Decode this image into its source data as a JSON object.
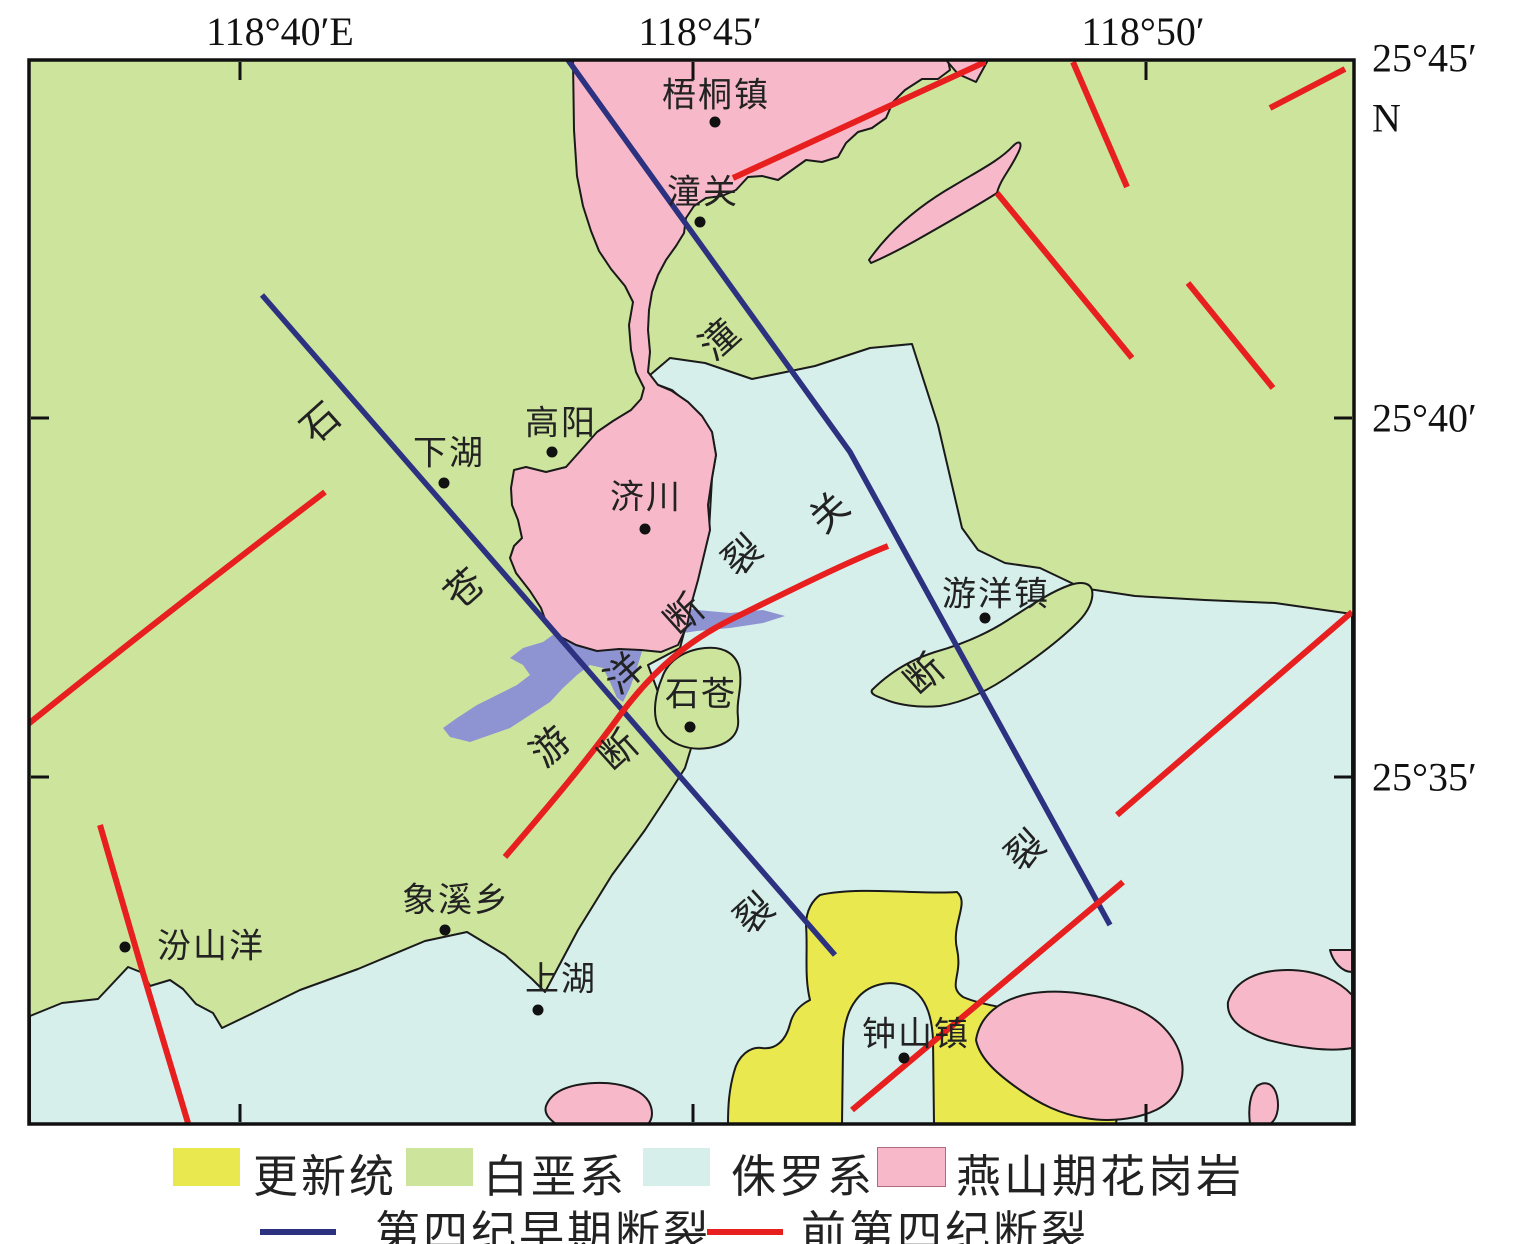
{
  "map_title_semantic": "geologic-structure-map",
  "axis": {
    "top_labels": [
      {
        "text": "118°40′E",
        "x": 280
      },
      {
        "text": "118°45′",
        "x": 700
      },
      {
        "text": "118°50′",
        "x": 1143
      }
    ],
    "right_labels": [
      {
        "text": "25°45′",
        "y": 58
      },
      {
        "text": "N",
        "y": 118
      },
      {
        "text": "25°40′",
        "y": 418
      },
      {
        "text": "25°35′",
        "y": 777
      }
    ],
    "tick_x": [
      240,
      693,
      1146
    ],
    "tick_y": [
      418,
      777
    ]
  },
  "towns": [
    {
      "name": "梧桐镇",
      "lx": 716,
      "ly": 92,
      "dx": 715,
      "dy": 122
    },
    {
      "name": "潼关",
      "lx": 703,
      "ly": 189,
      "dx": 700,
      "dy": 222
    },
    {
      "name": "高阳",
      "lx": 561,
      "ly": 420,
      "dx": 552,
      "dy": 452
    },
    {
      "name": "下湖",
      "lx": 449,
      "ly": 450,
      "dx": 444,
      "dy": 483
    },
    {
      "name": "济川",
      "lx": 646,
      "ly": 494,
      "dx": 645,
      "dy": 529
    },
    {
      "name": "游洋镇",
      "lx": 996,
      "ly": 591,
      "dx": 985,
      "dy": 618
    },
    {
      "name": "石苍",
      "lx": 701,
      "ly": 691,
      "dx": 690,
      "dy": 727
    },
    {
      "name": "象溪乡",
      "lx": 456,
      "ly": 897,
      "dx": 445,
      "dy": 930
    },
    {
      "name": "汾山洋",
      "lx": 211,
      "ly": 943,
      "dx": 125,
      "dy": 947
    },
    {
      "name": "上湖",
      "lx": 561,
      "ly": 976,
      "dx": 538,
      "dy": 1010
    },
    {
      "name": "钟山镇",
      "lx": 916,
      "ly": 1031,
      "dx": 904,
      "dy": 1058
    }
  ],
  "faults": [
    {
      "name": "石苍断裂",
      "type": "quaternary-early",
      "chars": [
        {
          "c": "石",
          "x": 318,
          "y": 420
        },
        {
          "c": "苍",
          "x": 462,
          "y": 586
        },
        {
          "c": "断",
          "x": 616,
          "y": 748
        },
        {
          "c": "裂",
          "x": 752,
          "y": 911
        }
      ]
    },
    {
      "name": "潼关断裂",
      "type": "quaternary-early",
      "chars": [
        {
          "c": "潼",
          "x": 717,
          "y": 337
        },
        {
          "c": "关",
          "x": 827,
          "y": 510
        },
        {
          "c": "断",
          "x": 922,
          "y": 672
        },
        {
          "c": "裂",
          "x": 1023,
          "y": 848
        }
      ]
    },
    {
      "name": "游洋断裂",
      "type": "pre-quaternary",
      "chars": [
        {
          "c": "游",
          "x": 548,
          "y": 744
        },
        {
          "c": "洋",
          "x": 622,
          "y": 671
        },
        {
          "c": "断",
          "x": 682,
          "y": 612
        },
        {
          "c": "裂",
          "x": 740,
          "y": 553
        }
      ]
    }
  ],
  "legend": {
    "geology": [
      {
        "label": "更新统",
        "color": "#e9e94f",
        "sx": 173,
        "tx": 253
      },
      {
        "label": "白垩系",
        "color": "#cde49c",
        "sx": 406,
        "tx": 483
      },
      {
        "label": "侏罗系",
        "color": "#d6efeb",
        "sx": 643,
        "tx": 731
      },
      {
        "label": "燕山期花岗岩",
        "color": "#f7b9c9",
        "sx": 878,
        "tx": 956
      }
    ],
    "faults": [
      {
        "label": "第四纪早期断裂",
        "color": "#2c3180",
        "sx": 260,
        "tx": 375
      },
      {
        "label": "前第四纪断裂",
        "color": "#e81f1f",
        "sx": 707,
        "tx": 801
      }
    ]
  },
  "colors": {
    "pleistocene": "#e9e94f",
    "cretaceous": "#cde49c",
    "jurassic": "#d6efeb",
    "yanshanian_granite": "#f7b9c9",
    "basin_purple": "#8e93d2",
    "fault_quaternary_early": "#2c3180",
    "fault_pre_quaternary": "#e81f1f"
  }
}
